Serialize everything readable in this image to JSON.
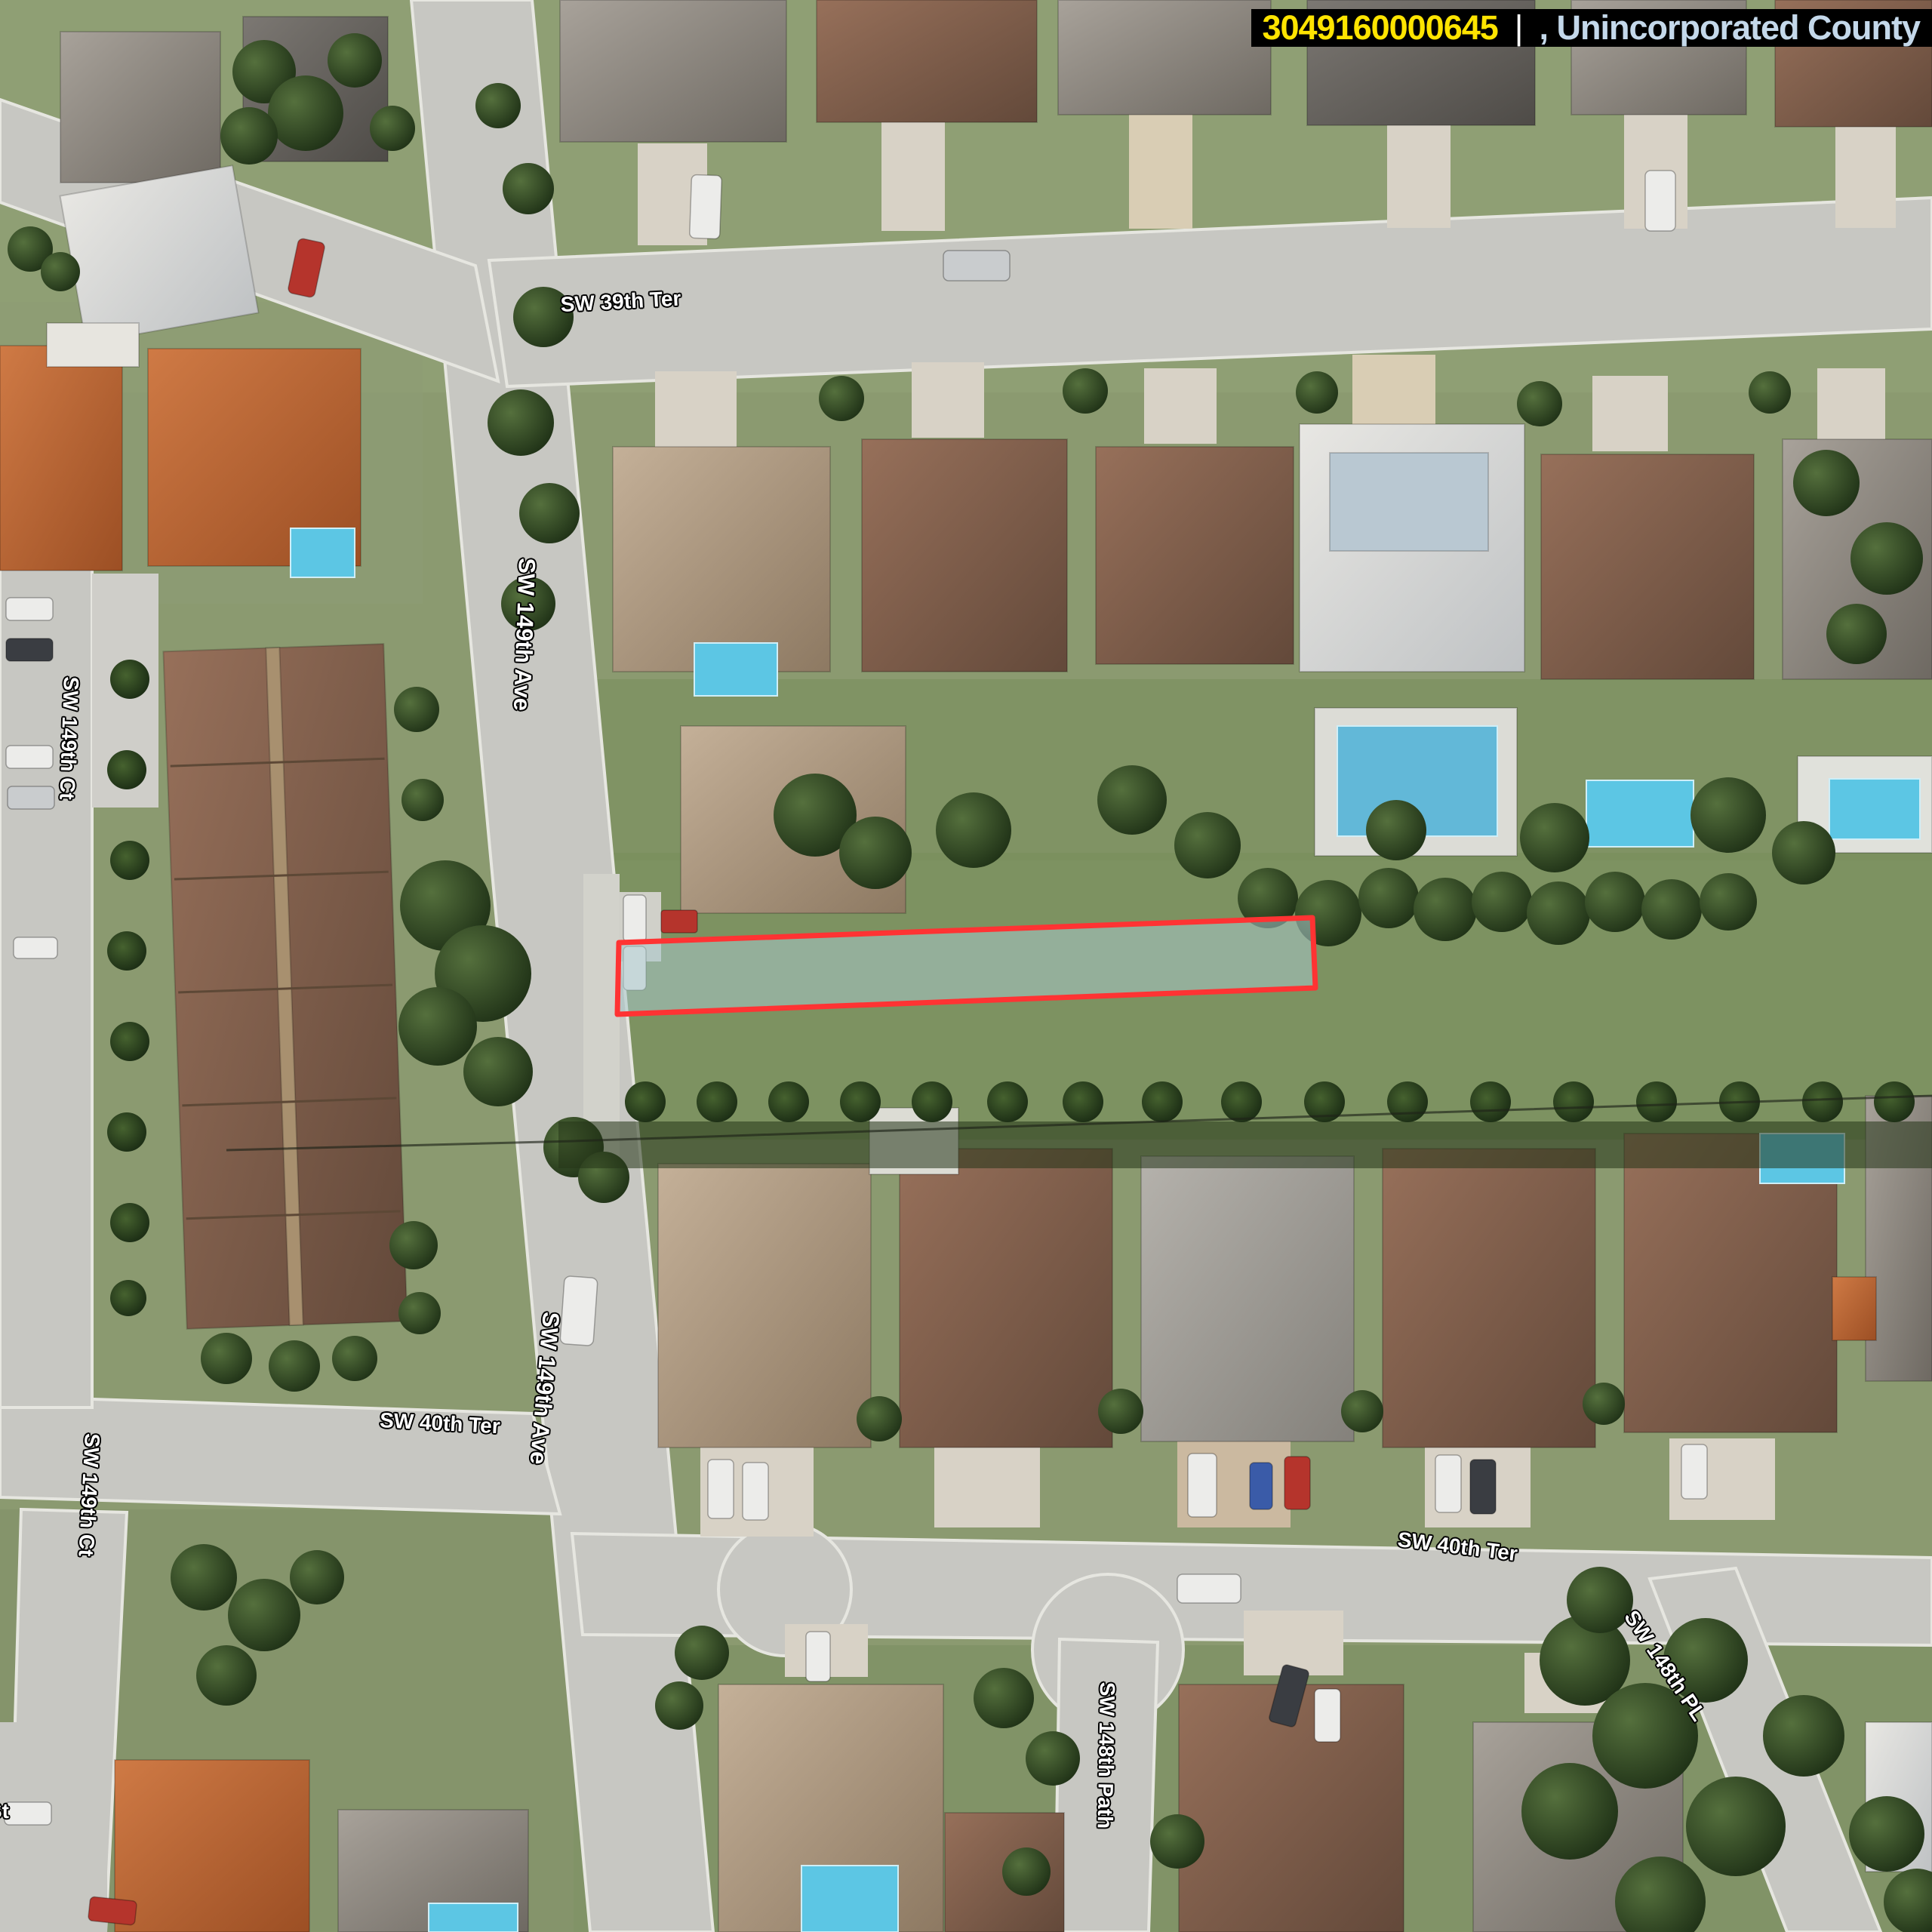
{
  "header": {
    "folio": "3049160000645",
    "separator": "|",
    "jurisdiction": ", Unincorporated County",
    "folio_color": "#FFE400",
    "jurisdiction_color": "#C4D8EA",
    "background": "#000000"
  },
  "map": {
    "type": "aerial-imagery",
    "parcel": {
      "folio": "3049160000645",
      "outline_color": "#FF3333",
      "fill_color": "rgba(168,199,203,0.55)"
    },
    "label_style": {
      "text_color": "#FFFFFF",
      "outline_color": "#000000"
    },
    "street_labels": [
      {
        "id": "sw-39th-ter",
        "text": "SW 39th Ter"
      },
      {
        "id": "sw-149th-ave-north",
        "text": "SW 149th Ave"
      },
      {
        "id": "sw-149th-ct-north",
        "text": "SW 149th Ct"
      },
      {
        "id": "sw-40th-ter-west",
        "text": "SW 40th Ter"
      },
      {
        "id": "sw-149th-ave-south",
        "text": "SW 149th Ave"
      },
      {
        "id": "sw-149th-ct-south",
        "text": "SW 149th Ct"
      },
      {
        "id": "sw-40th-ter-east",
        "text": "SW 40th Ter"
      },
      {
        "id": "sw-148th-path",
        "text": "SW 148th Path"
      },
      {
        "id": "sw-148th-pl",
        "text": "SW 148th PL"
      },
      {
        "id": "street-label-partial",
        "text": "St"
      }
    ]
  }
}
